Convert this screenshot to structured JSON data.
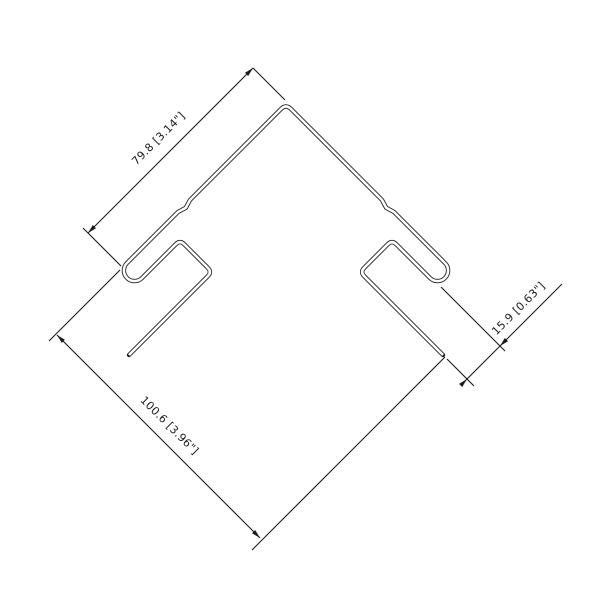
{
  "drawing": {
    "background": "#ffffff",
    "line_color": "#1b1b1b",
    "dimensions": {
      "face": {
        "label": "79.8 [3.14\"]",
        "value_mm": 79.8,
        "value_in": 3.14
      },
      "pocket": {
        "label": "15.9 [0.63\"]",
        "value_mm": 15.9,
        "value_in": 0.63
      },
      "overall": {
        "label": "100.6 [3.96\"]",
        "value_mm": 100.6,
        "value_in": 3.96
      }
    }
  }
}
